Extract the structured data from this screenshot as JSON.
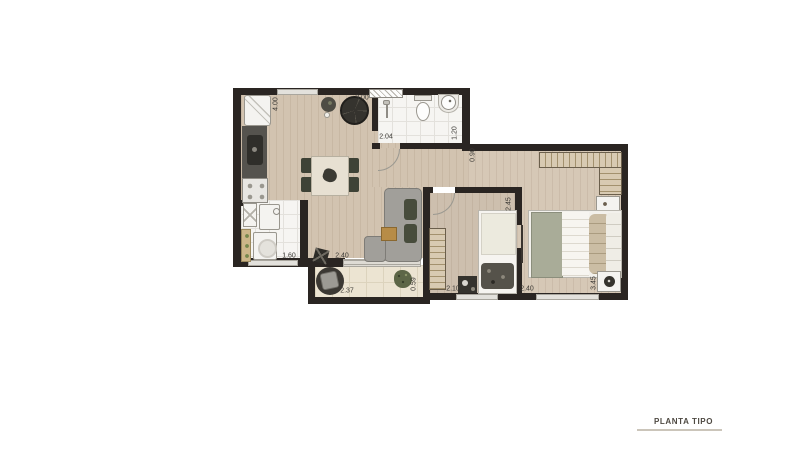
{
  "title_block": {
    "label": "PLANTA TIPO"
  },
  "dimensions": [
    {
      "id": "kitchen-wall-height",
      "value": "4.00",
      "orientation": "vertical"
    },
    {
      "id": "living-top-width",
      "value": "3.00",
      "orientation": "horizontal"
    },
    {
      "id": "bathroom-width",
      "value": "2.04",
      "orientation": "horizontal"
    },
    {
      "id": "bathroom-depth",
      "value": "1.20",
      "orientation": "vertical"
    },
    {
      "id": "hall-width",
      "value": "0.90",
      "orientation": "vertical"
    },
    {
      "id": "bedroom2-depth",
      "value": "2.45",
      "orientation": "vertical"
    },
    {
      "id": "service-width",
      "value": "1.60",
      "orientation": "horizontal"
    },
    {
      "id": "living-width",
      "value": "2.40",
      "orientation": "horizontal"
    },
    {
      "id": "balcony-width",
      "value": "2.37",
      "orientation": "horizontal"
    },
    {
      "id": "balcony-depth",
      "value": "0.59",
      "orientation": "vertical"
    },
    {
      "id": "bedroom2-width",
      "value": "2.10",
      "orientation": "horizontal"
    },
    {
      "id": "bedroom1-width",
      "value": "2.40",
      "orientation": "horizontal"
    },
    {
      "id": "bedroom1-depth",
      "value": "3.45",
      "orientation": "vertical"
    }
  ],
  "colors": {
    "wall": "#2a2522",
    "wood_floor": "#d2c3b0",
    "tile_floor": "#f6f5f2",
    "balcony_floor": "#ece4d2",
    "title_text": "#4e4942",
    "title_line": "#cbc5ba",
    "dimension_text": "#3c3a36"
  }
}
